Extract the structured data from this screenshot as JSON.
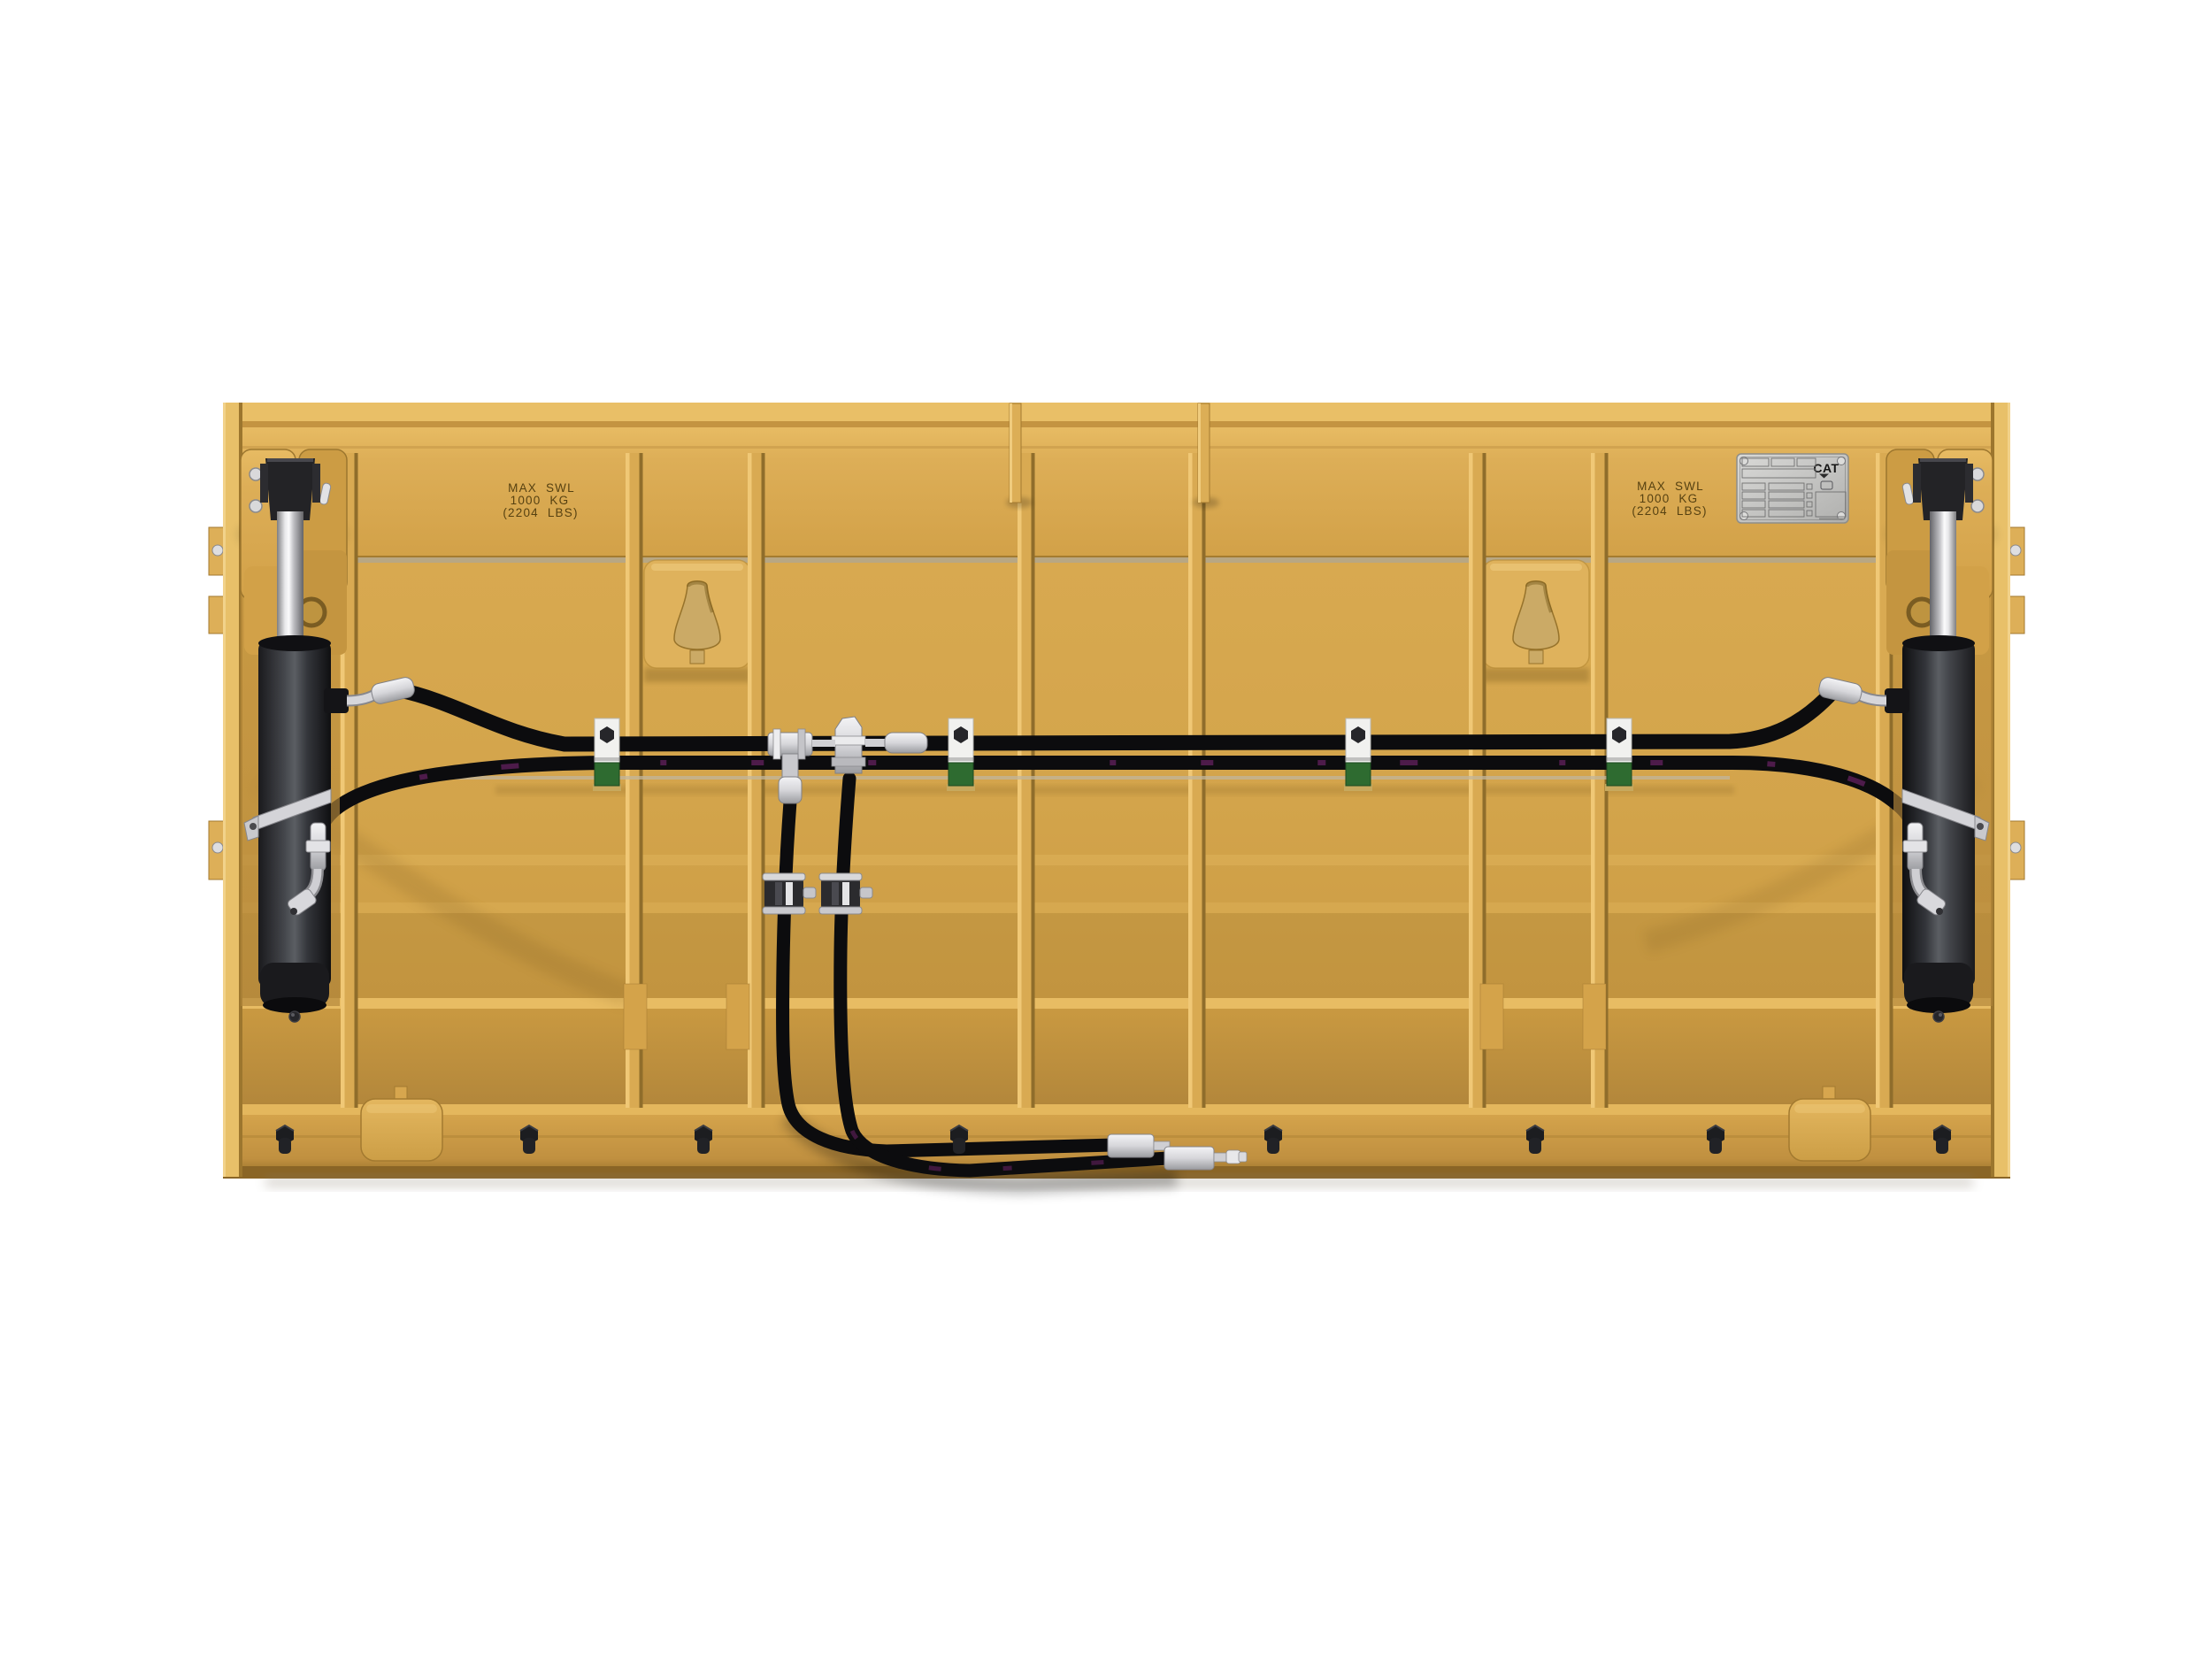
{
  "image": {
    "type": "3d-product-render",
    "subject": "Rear view of a yellow work tool attachment frame with two vertical hydraulic cylinders, cross-routed hydraulic hoses, hose clamps and bulkhead fittings",
    "background": "#ffffff"
  },
  "markings": {
    "swl_left": {
      "line1": "MAX SWL",
      "line2": "1000 KG",
      "line3": "(2204 LBS)"
    },
    "swl_right": {
      "line1": "MAX SWL",
      "line2": "1000 KG",
      "line3": "(2204 LBS)"
    }
  },
  "serial_plate": {
    "brand": "CAT"
  },
  "colors": {
    "cat_yellow": "#D6A64D",
    "yellow_highlight": "#EAC06A",
    "yellow_shadow": "#A87F33",
    "hose_black": "#0E0E10",
    "cylinder_gray": "#3C3E42",
    "chrome": "#E9E9EB",
    "fitting_silver": "#D3D3D7",
    "clamp_white": "#F1F1EF",
    "clamp_green": "#2E6B30",
    "plate_silver": "#C6C6C4",
    "bolt_black": "#1C1D20",
    "hose_glint_purple": "#8E2A86",
    "stamp_text": "#564111"
  }
}
